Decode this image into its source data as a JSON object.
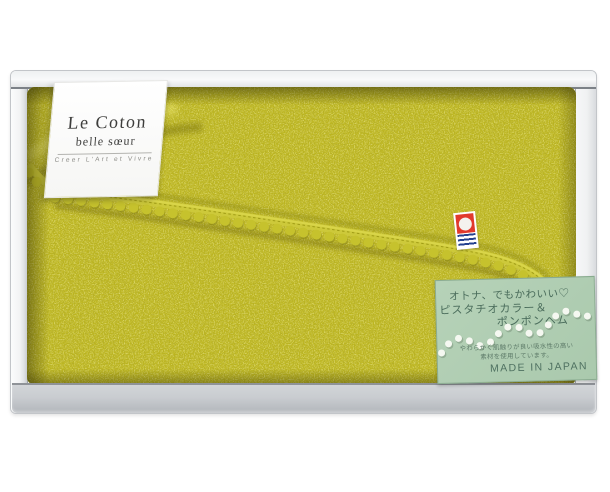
{
  "page": {
    "background_color": "#ffffff"
  },
  "brand_card": {
    "title": "Le Coton",
    "subtitle": "belle sœur",
    "tagline": "Creer L'Art et Vivre"
  },
  "imabari_logo": {
    "name": "imabari-towel-logo",
    "red": "#e13a2d",
    "blue": "#24418f",
    "white": "#ffffff"
  },
  "info_tag": {
    "headline": "オトナ、でもかわいい♡",
    "feature_line1": "ピスタチオカラー＆",
    "feature_line2": "ポンポンヘム",
    "note_line1": "やわらかく肌触りが良い吸水性の高い",
    "note_line2": "素材を使用しています。",
    "origin": "MADE IN JAPAN",
    "background_color": "#afccb2",
    "text_color": "#4a6c5b"
  },
  "colors": {
    "towel": "#bcb520",
    "box_rim": "#f6f7f8",
    "box_wall": "#c3c7cb"
  }
}
